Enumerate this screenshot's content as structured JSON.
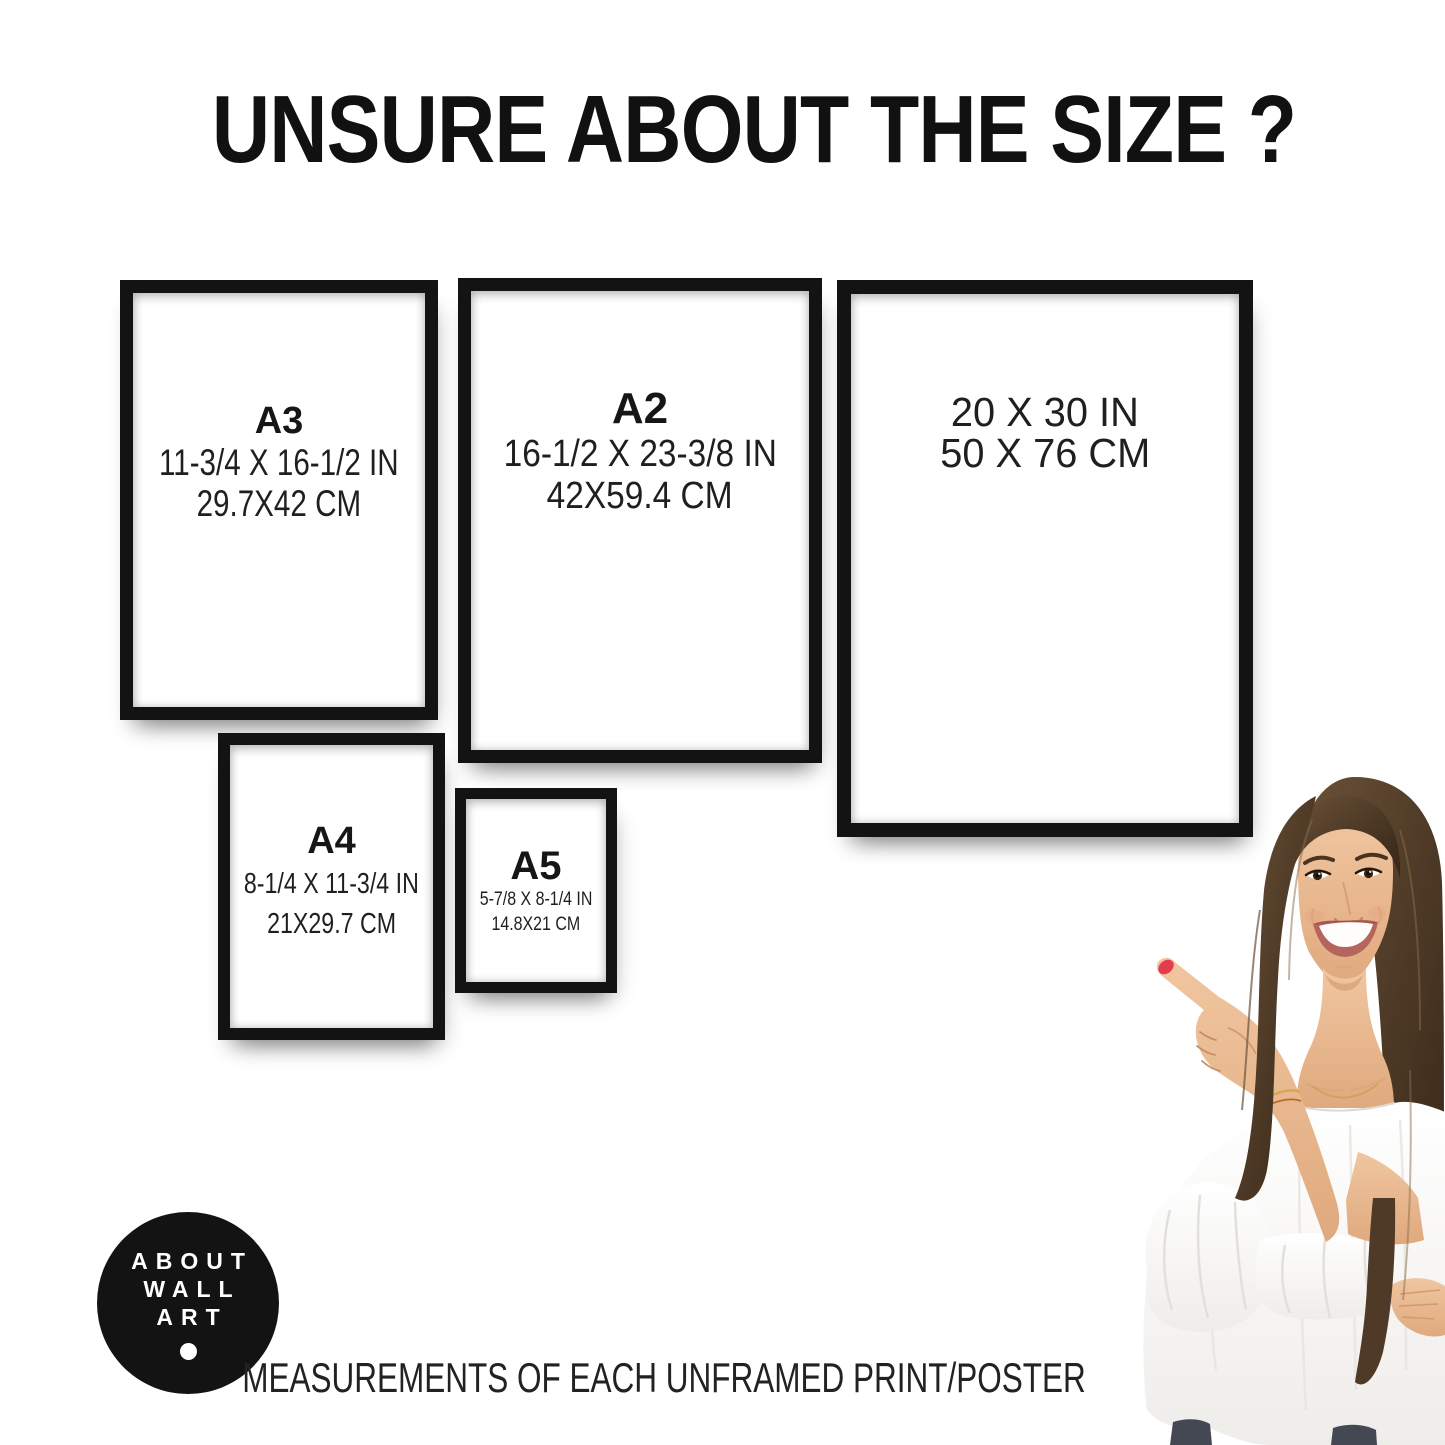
{
  "title": "UNSURE ABOUT THE SIZE ?",
  "frames": [
    {
      "name": "A3",
      "inches": "11-3/4 X 16-1/2 IN",
      "cm": "29.7X42 CM"
    },
    {
      "name": "A2",
      "inches": "16-1/2 X 23-3/8 IN",
      "cm": "42X59.4 CM"
    },
    {
      "name": "",
      "inches": "20 X 30 IN",
      "cm": "50 X 76 CM"
    },
    {
      "name": "A4",
      "inches": "8-1/4 X 11-3/4 IN",
      "cm": "21X29.7 CM"
    },
    {
      "name": "A5",
      "inches": "5-7/8 X 8-1/4 IN",
      "cm": "14.8X21 CM"
    }
  ],
  "logo": {
    "lines": [
      "ABOUT",
      "WALL",
      "ART"
    ]
  },
  "footer_caption": "MEASUREMENTS OF EACH UNFRAMED PRINT/POSTER",
  "colors": {
    "frame_black": "#131313",
    "background": "#ffffff",
    "text": "#1d1d1d",
    "logo_bg": "#131313",
    "logo_text": "#ffffff",
    "nail_red": "#e23d4e",
    "hair_brown": "#4e3a26",
    "skin": "#ecc09a",
    "blouse_white": "#fafaf9",
    "jeans": "#434853"
  }
}
